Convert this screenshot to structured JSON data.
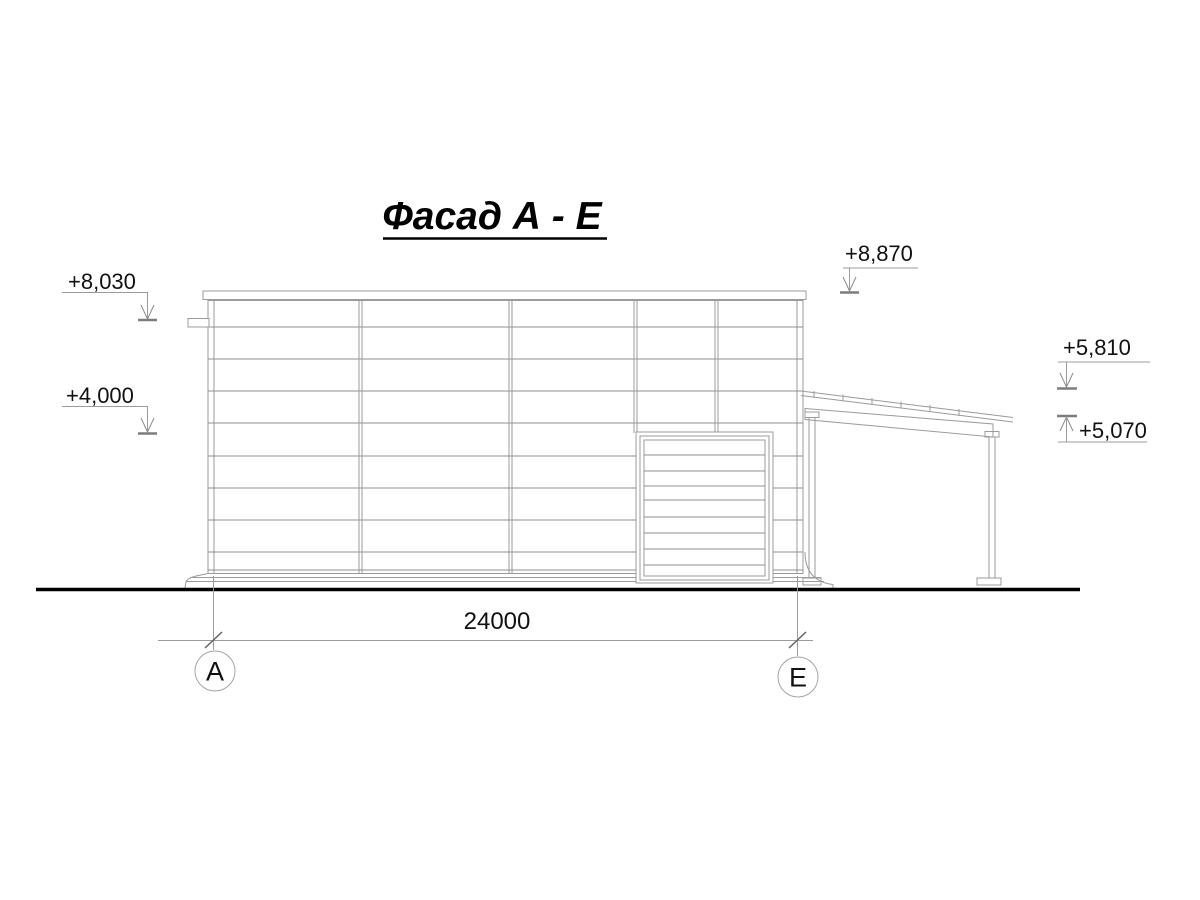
{
  "title": "Фасад А - Е",
  "drawing_type": "building elevation",
  "colors": {
    "line": "#9b9b9b",
    "text": "#111111",
    "ground_line": "#000000",
    "background": "#ffffff"
  },
  "elevation_marks": {
    "m8030": {
      "label": "+8,030",
      "side": "left",
      "arrow": "down"
    },
    "m4000": {
      "label": "+4,000",
      "side": "left",
      "arrow": "down"
    },
    "m8870": {
      "label": "+8,870",
      "side": "top-right",
      "arrow": "down"
    },
    "m5810": {
      "label": "+5,810",
      "side": "right",
      "arrow": "down"
    },
    "m5070": {
      "label": "+5,070",
      "side": "right",
      "arrow": "up"
    }
  },
  "dimension": {
    "span_label": "24000"
  },
  "axes": {
    "left": "А",
    "right": "Е"
  }
}
